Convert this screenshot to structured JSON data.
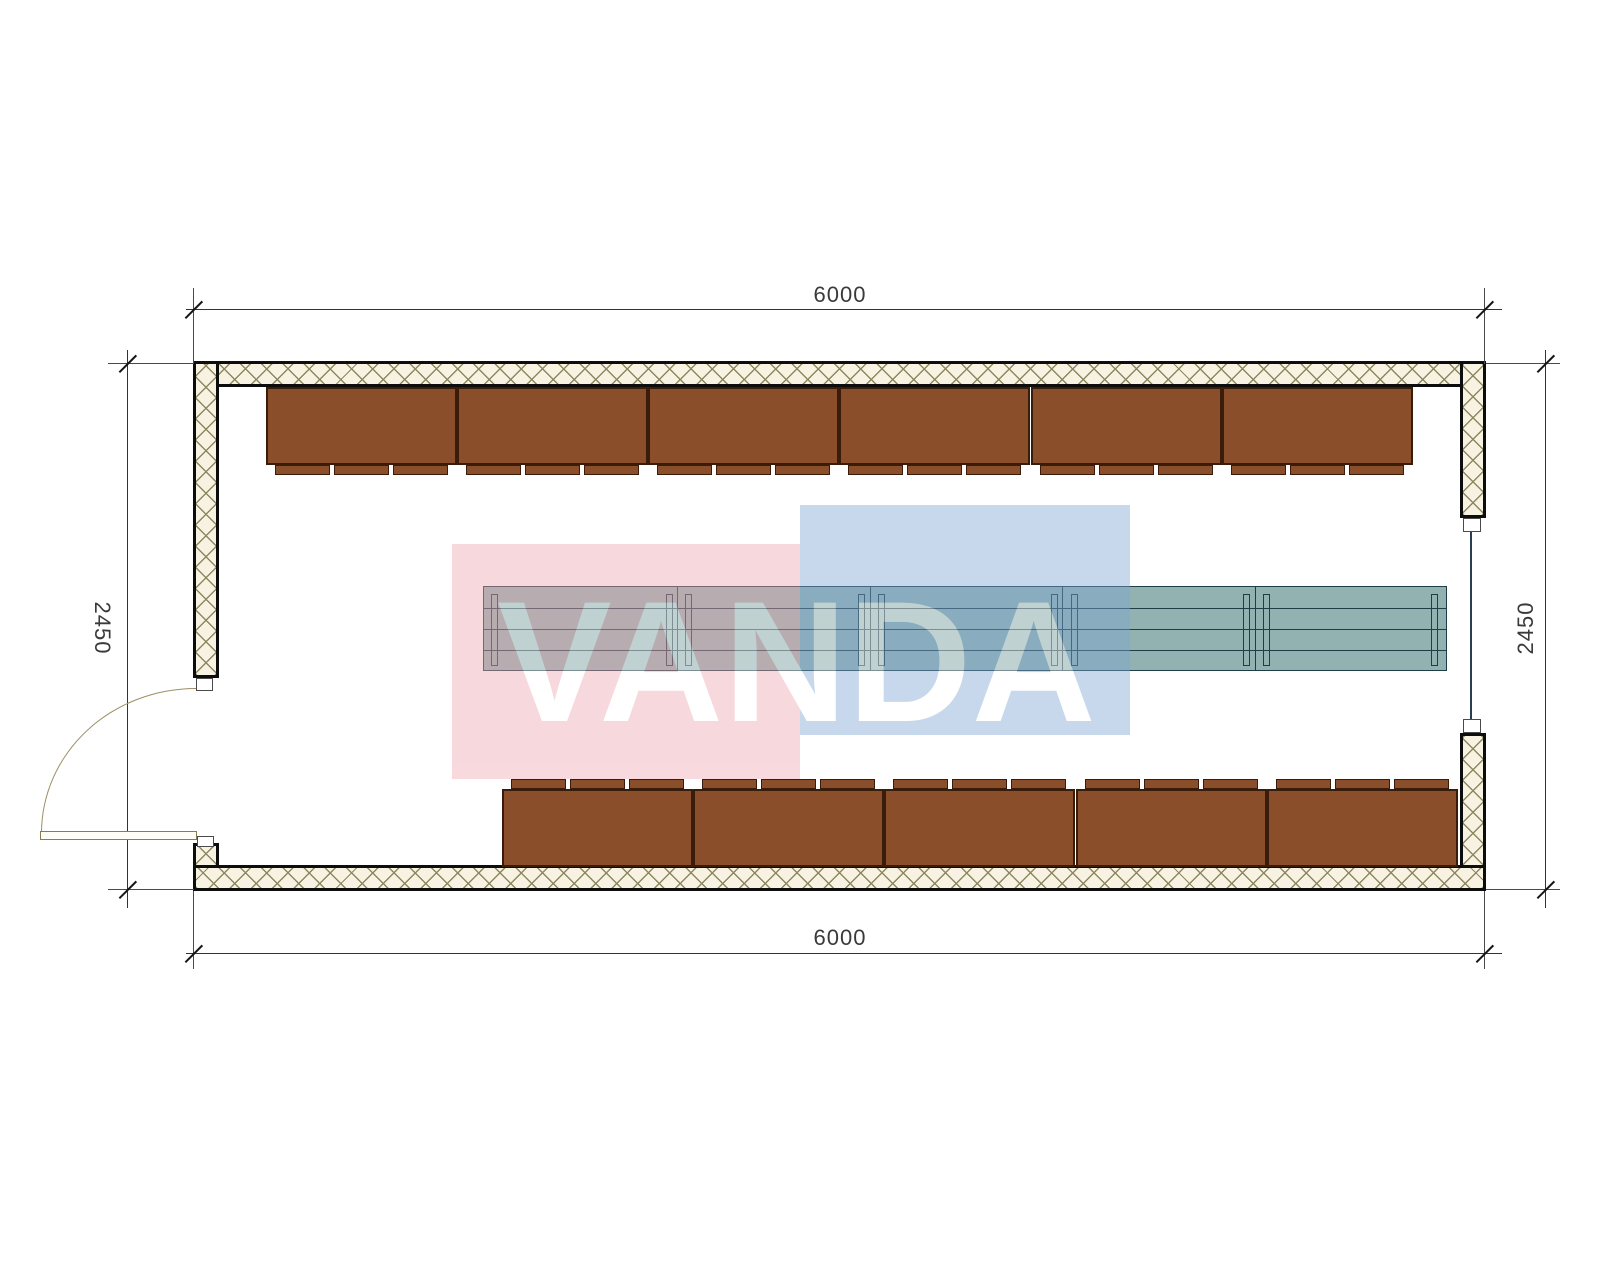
{
  "drawing": {
    "type": "floor-plan",
    "dimensions": {
      "top": "6000",
      "bottom": "6000",
      "left": "2450",
      "right": "2450"
    },
    "watermark": {
      "text": "VANDA",
      "pink_color": "#ECA4B0",
      "blue_color": "#7EA4D2",
      "text_color": "#FFFFFF",
      "layer_opacity": 0.42,
      "pink_rect": {
        "x": 452,
        "y": 544,
        "w": 348,
        "h": 235
      },
      "blue_rect": {
        "x": 800,
        "y": 505,
        "w": 330,
        "h": 230
      }
    },
    "colors": {
      "bench_fill": "#8B4E2B",
      "bench_border": "#3A1C0B",
      "wall_hatch_bg": "#F7F2E2",
      "wall_hatch_line": "#8E8860",
      "wall_outline": "#0D0D0D",
      "table_fill": "#92B2B1",
      "table_line": "#1F3D47",
      "door_line": "#9C8F63",
      "dim_line": "#333333"
    },
    "benches": {
      "tabs_per_block": 3,
      "tab_offsets": [
        9,
        68,
        127
      ],
      "tab_width": 55,
      "tab_height": 10,
      "block_width": 191,
      "block_height": 78,
      "top_row": {
        "count": 6,
        "y": 387,
        "tab_side": "below",
        "lefts": [
          266,
          457,
          648,
          839,
          1031,
          1222
        ]
      },
      "bottom_row": {
        "count": 5,
        "y": 789,
        "tab_side": "above",
        "lefts": [
          502,
          693,
          884,
          1076,
          1267
        ]
      }
    },
    "table": {
      "x": 483,
      "y": 586,
      "width": 964,
      "height": 85,
      "segment_count": 5,
      "divider_offsets": [
        193,
        386,
        578,
        771
      ],
      "hline_offsets": [
        21,
        42,
        63
      ],
      "leg_lefts": [
        7,
        182,
        201,
        374,
        394,
        567,
        587,
        759,
        779,
        947
      ]
    }
  }
}
